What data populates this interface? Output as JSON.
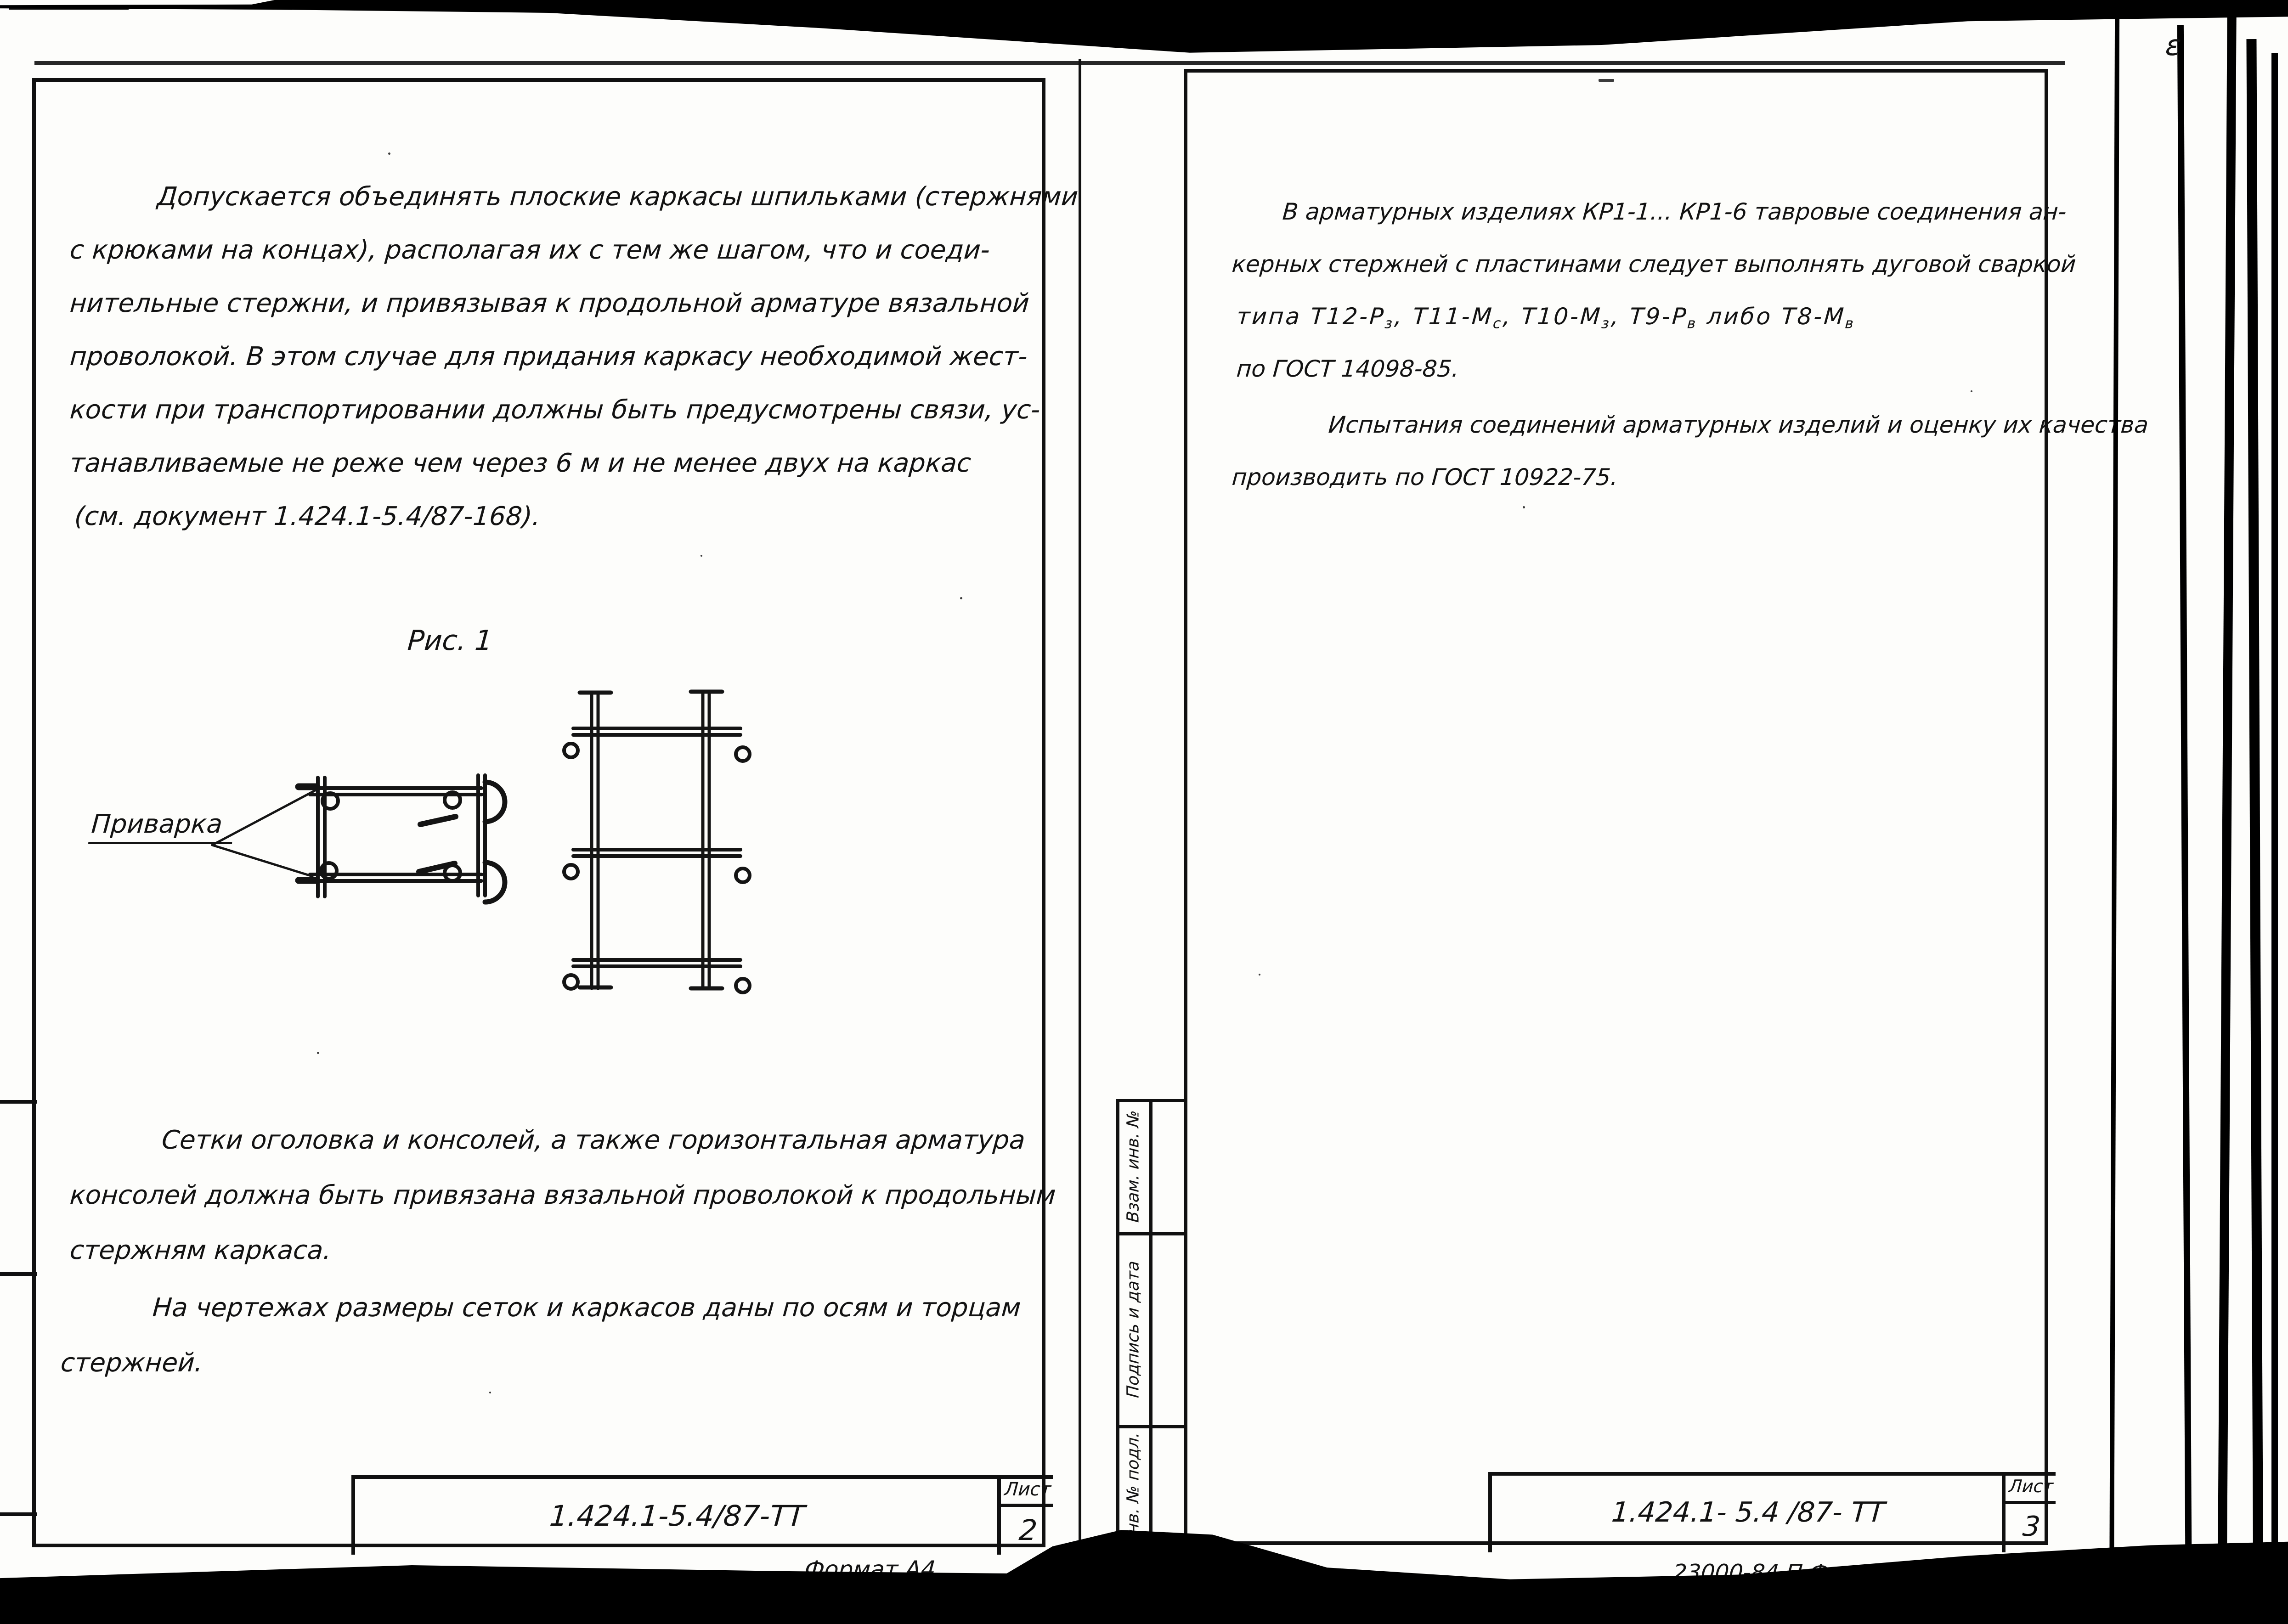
{
  "left_page": {
    "paragraph1": [
      "Допускается объединять плоские каркасы шпильками (стержнями",
      "с крюками на концах), располагая их с тем же шагом, что и соеди-",
      "нительные стержни, и привязывая к продольной арматуре вязальной",
      "проволокой.  В этом случае для придания каркасу необходимой жест-",
      "кости при транспортировании должны быть предусмотрены связи, ус-",
      "танавливаемые не реже чем через 6 м и не менее двух на каркас",
      "(см. документ 1.424.1-5.4/87-168)."
    ],
    "figure": {
      "caption": "Рис. 1",
      "weld_label": "Приварка"
    },
    "paragraph2": [
      "Сетки оголовка и консолей, а также горизонтальная арматура",
      "консолей должна быть привязана вязальной проволокой к продольным",
      "стержням каркаса."
    ],
    "paragraph3": [
      "На чертежах размеры сеток и каркасов даны по осям и торцам",
      "стержней."
    ],
    "title_block": {
      "code": "1.424.1-5.4/87-ТТ",
      "sheet_label": "Лист",
      "sheet_number": "2"
    },
    "format_note": "Формат А4"
  },
  "right_page": {
    "p1_line1": "В арматурных изделиях КР1-1... КР1-6 тавровые соединения ан-",
    "p1_line2": "керных стержней с пластинами следует выполнять дуговой сваркой",
    "p1_line3_segments": [
      {
        "t": "типа Т12-Р"
      },
      {
        "t": "з",
        "sub": true
      },
      {
        "t": ", Т11-М"
      },
      {
        "t": "с",
        "sub": true
      },
      {
        "t": ", Т10-М"
      },
      {
        "t": "з",
        "sub": true
      },
      {
        "t": ", Т9-Р"
      },
      {
        "t": "в",
        "sub": true
      },
      {
        "t": " либо Т8-М"
      },
      {
        "t": "в",
        "sub": true
      }
    ],
    "p1_line4": "по ГОСТ 14098-85.",
    "paragraph2": [
      "Испытания соединений арматурных изделий и оценку их качества",
      "производить по ГОСТ 10922-75."
    ],
    "sidebar_labels": [
      "Взам. инв. №",
      "Подпись и дата",
      "Инв. № подл."
    ],
    "title_block": {
      "code": "1.424.1- 5.4 /87- ТТ",
      "sheet_label": "Лист",
      "sheet_number": "3"
    },
    "stamp_note": "23000-84    П     Ф",
    "corner_mark": "ε"
  }
}
